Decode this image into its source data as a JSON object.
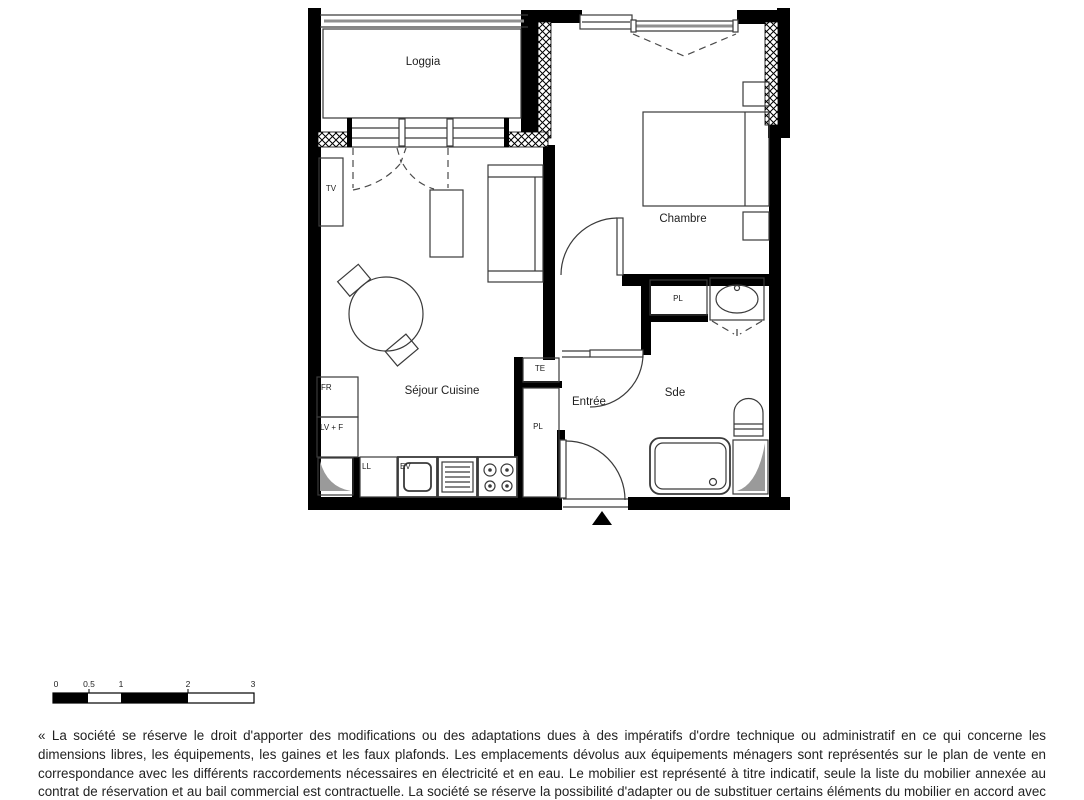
{
  "plan": {
    "rooms": {
      "loggia": "Loggia",
      "chambre": "Chambre",
      "sejour_cuisine": "Séjour Cuisine",
      "entree": "Entrée",
      "sde": "Sde"
    },
    "labels": {
      "tv": "TV",
      "fr": "FR",
      "lv_f": "LV + F",
      "ll": "LL",
      "ev": "EV",
      "te": "TE",
      "pl_hall": "PL",
      "pl_bath": "PL"
    },
    "colors": {
      "wall": "#000000",
      "duct_gray": "#9a9a9a",
      "text": "#1f1f1f"
    }
  },
  "scale_bar": {
    "ticks": [
      "0",
      "0.5",
      "1",
      "2",
      "3"
    ]
  },
  "disclaimer": "« La société se réserve le droit d'apporter des modifications ou des adaptations dues à des impératifs d'ordre technique ou administratif en ce qui concerne les dimensions libres, les équipements, les gaines et les faux plafonds. Les emplacements dévolus aux équipements ménagers sont représentés sur le plan de vente en correspondance avec les différents raccordements nécessaires en électricité et en eau. Le mobilier est représenté à titre indicatif, seule la liste du mobilier annexée au contrat de réservation et au bail commercial est contractuelle. La société se réserve la possibilité d'adapter ou de substituer certains éléments du mobilier en accord avec le décorateur et le gestionnaire. »"
}
